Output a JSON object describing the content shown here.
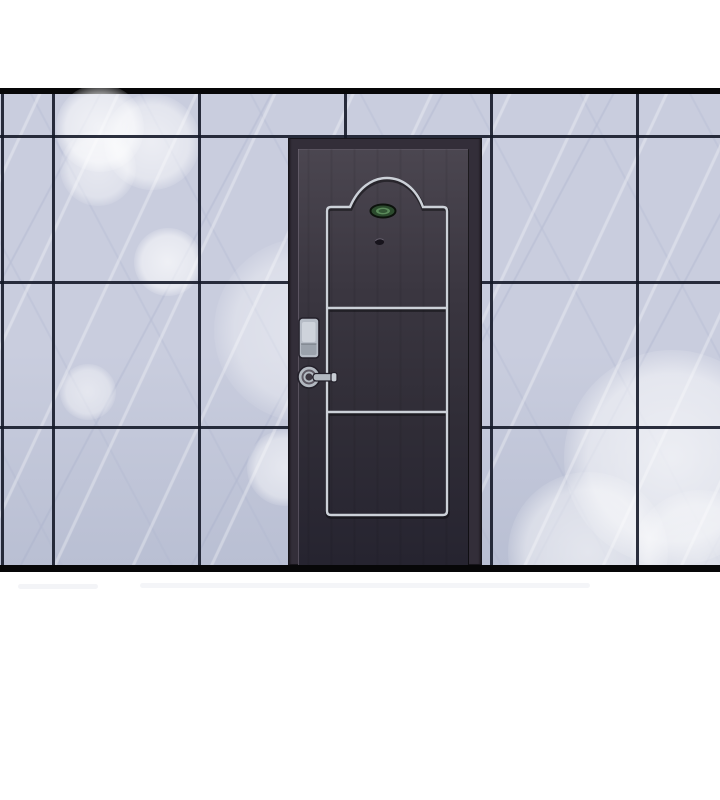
{
  "scene": {
    "description": "Comic/webtoon style panel: a dark charcoal apartment entrance door with silver arched trim moulding, a small green room-number plate, a peephole, a digital keypad lock and a lever handle, set into a wall of large light marble tiles with soft white light glare; solid black bars frame the panel top and bottom on a white page.",
    "page_background": "#ffffff"
  },
  "colors": {
    "panel_border": "#070708",
    "tile": "#c9cdde",
    "tile_shade": "#b9bfd3",
    "grout": "#151a29",
    "door_frame": "#332e39",
    "door_frame_edge": "#17151b",
    "door_slab_top": "#4b4650",
    "door_slab_bottom": "#262430",
    "trim_silver": "#ccd1d8",
    "trim_shadow": "#0e0e13",
    "plate_green_dark": "#2b4a2d",
    "plate_green_light": "#5b8a5b",
    "plate_border": "#0c120c",
    "peephole_dark": "#17141c",
    "peephole_rim": "#6a6472",
    "keypad_body": "#b6bcc6",
    "keypad_screen": "#ced3db",
    "keypad_band": "#9ba2ac",
    "metal_outline": "#23202a",
    "handle_metal": "#b3b9c1",
    "handle_hub": "#3b3640",
    "smudge": "#e7e9ef"
  },
  "panel": {
    "top_bar": {
      "y": 88,
      "height": 6
    },
    "bottom_bar": {
      "y": 565,
      "height": 7
    }
  },
  "wall": {
    "region": {
      "x": 0,
      "y": 94,
      "width": 720,
      "height": 471
    },
    "vertical_grout_x": [
      1,
      52,
      198,
      344,
      490,
      636
    ],
    "horizontal_grout_y": [
      135,
      281,
      426
    ],
    "bokeh_glows": [
      {
        "x": 100,
        "y": 128,
        "r": 44,
        "o": 0.75
      },
      {
        "x": 152,
        "y": 142,
        "r": 48,
        "o": 0.65
      },
      {
        "x": 98,
        "y": 168,
        "r": 38,
        "o": 0.55
      },
      {
        "x": 168,
        "y": 262,
        "r": 34,
        "o": 0.7
      },
      {
        "x": 306,
        "y": 330,
        "r": 92,
        "o": 0.45
      },
      {
        "x": 88,
        "y": 392,
        "r": 28,
        "o": 0.55
      },
      {
        "x": 285,
        "y": 468,
        "r": 38,
        "o": 0.6
      },
      {
        "x": 672,
        "y": 458,
        "r": 108,
        "o": 0.7
      },
      {
        "x": 588,
        "y": 552,
        "r": 80,
        "o": 0.6
      },
      {
        "x": 700,
        "y": 560,
        "r": 70,
        "o": 0.55
      }
    ]
  },
  "door": {
    "region": {
      "x": 288,
      "y": 138,
      "width": 194,
      "height": 427
    },
    "panels": 3,
    "elements": [
      "frame",
      "slab",
      "silver-trim-moulding-with-arched-top",
      "room-number-plate",
      "peephole",
      "digital-keypad-lock",
      "lever-handle"
    ],
    "plate_text_legible": false
  },
  "floor_smudges": [
    {
      "x": 18,
      "y": 584,
      "width": 80,
      "opacity": 0.5
    },
    {
      "x": 140,
      "y": 583,
      "width": 450,
      "opacity": 0.45
    }
  ]
}
